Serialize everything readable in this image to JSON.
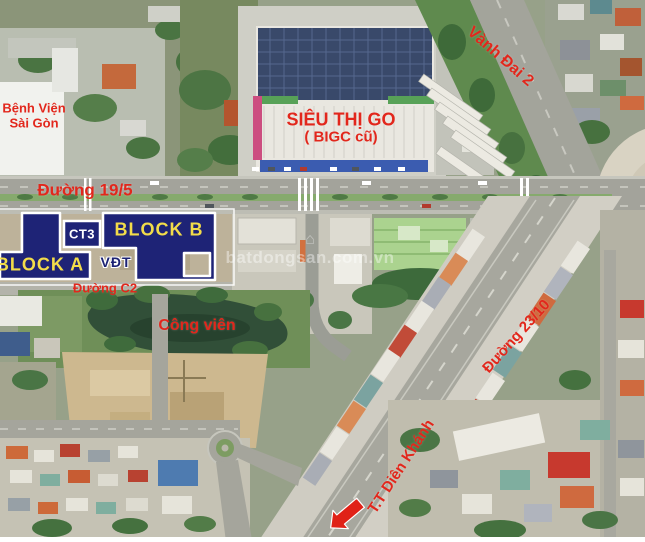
{
  "watermark": {
    "text": "batdongsan.com.vn",
    "icon": "house-icon"
  },
  "labels": {
    "hospital_line1": "Bệnh Viện",
    "hospital_line2": "Sài Gòn",
    "supermarket_line1": "SIÊU THỊ GO",
    "supermarket_line2": "( BIGC cũ)",
    "ring_road": "Vành Đai 2",
    "road_19_5": "Đường 19/5",
    "road_c2": "Đường C2",
    "park": "Công viên",
    "road_23_10": "Đường 23/10",
    "town": "T.T Diên Khánh"
  },
  "blocks": {
    "block_a": "BLOCK A",
    "block_b": "BLOCK B",
    "ct3": "CT3",
    "vdt": "VĐT"
  },
  "colors": {
    "label_red": "#e2271c",
    "block_navy": "#1e2376",
    "block_yellow": "#f2dc4a",
    "block_outline_white": "#ffffff",
    "arrow_red": "#e02117",
    "solar_roof_navy": "#39496a",
    "water_green": "#314f38"
  },
  "icons": {
    "direction_arrow": "arrow-down-left-icon",
    "watermark_house": "house-icon"
  }
}
